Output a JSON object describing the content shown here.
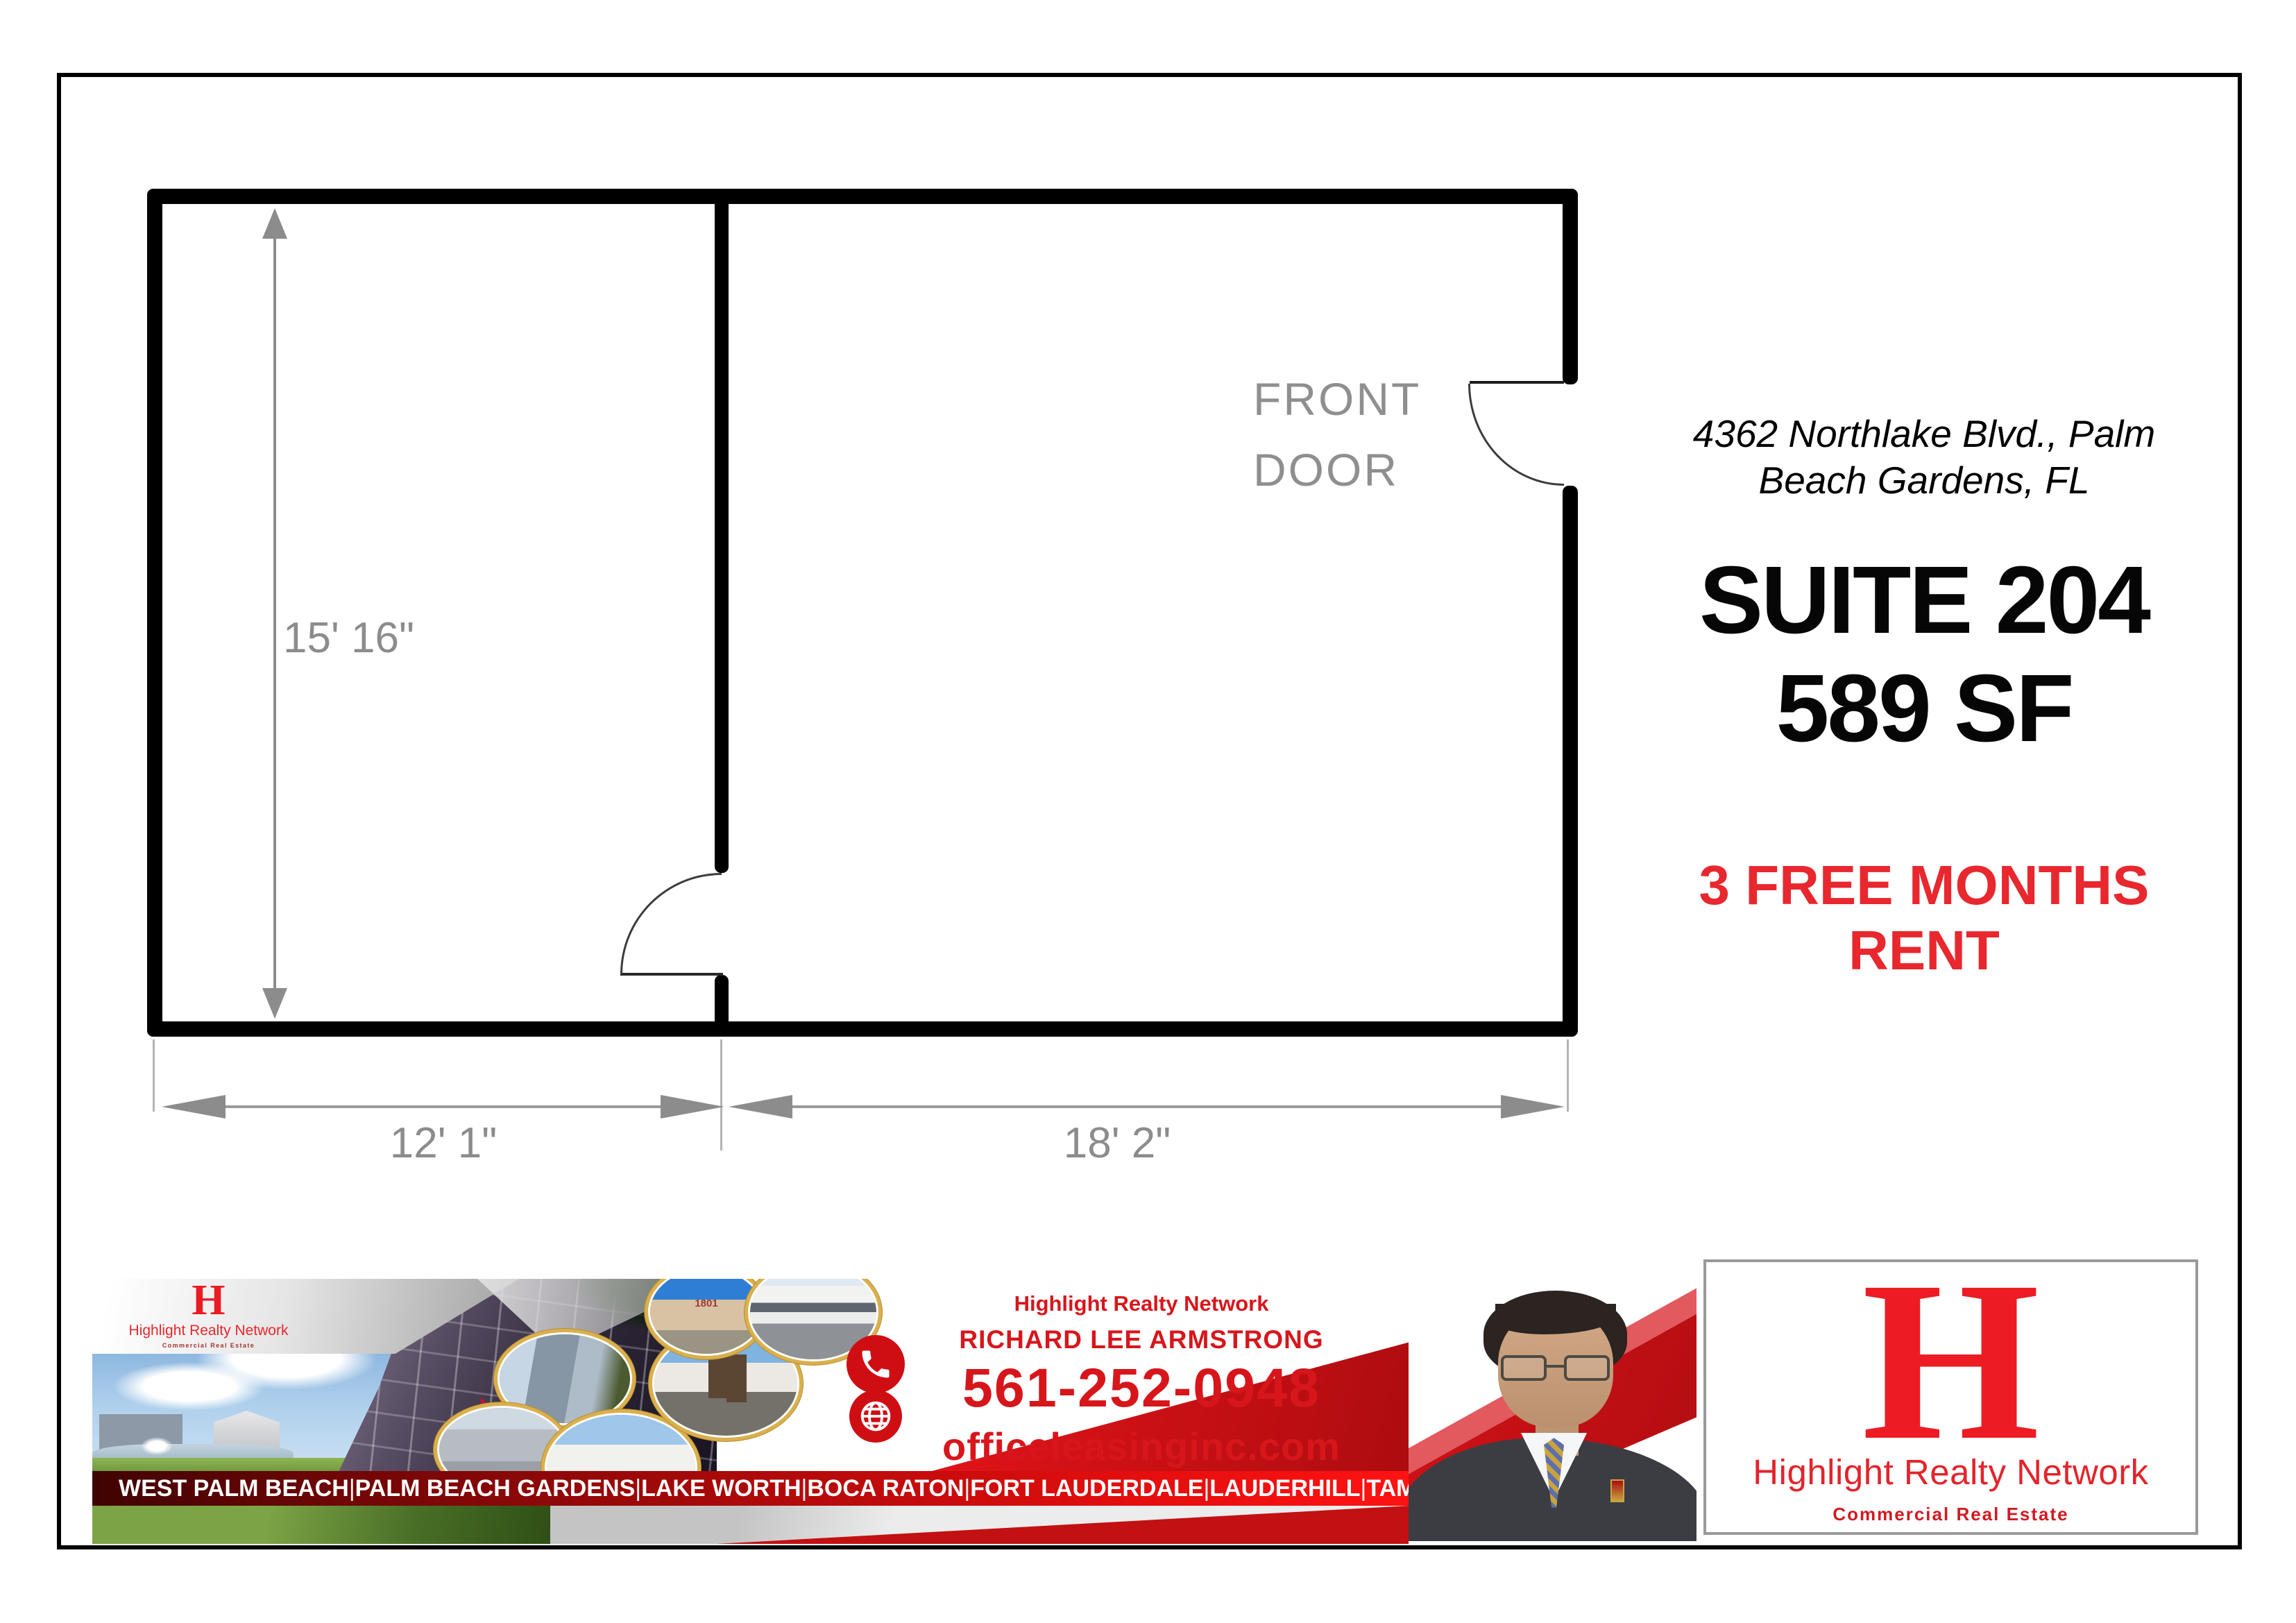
{
  "listing": {
    "address_line1": "4362 Northlake Blvd., Palm",
    "address_line2": "Beach Gardens, FL",
    "suite": "SUITE 204",
    "area": "589 SF",
    "promo_line1": "3 FREE MONTHS",
    "promo_line2": "RENT",
    "promo_color": "#e8272e"
  },
  "floorplan": {
    "front_door_line1": "FRONT",
    "front_door_line2": "DOOR",
    "dim_height": "15' 16\"",
    "dim_width_left": "12' 1\"",
    "dim_width_right": "18' 2\""
  },
  "banner": {
    "logo_monogram": "H",
    "logo_name": "Highlight Realty Network",
    "logo_tagline": "Commercial Real Estate",
    "network_title": "Highlight Realty Network",
    "agent_name": "RICHARD LEE ARMSTRONG",
    "phone": "561-252-0948",
    "website": "officeleasinginc.com",
    "oval_photo_label": "1801",
    "cities": [
      "WEST PALM BEACH",
      "PALM BEACH GARDENS",
      "LAKE WORTH",
      "BOCA RATON",
      "FORT LAUDERDALE",
      "LAUDERHILL",
      "TAMARAC"
    ],
    "city_separator": "|"
  },
  "logo_box": {
    "monogram": "H",
    "name": "Highlight Realty Network",
    "tagline": "Commercial Real Estate"
  },
  "colors": {
    "brand_red": "#d7161c",
    "strip_dark_red": "#3f0303",
    "strip_bright_red": "#ff1212",
    "dim_gray": "#8c8c8c",
    "wall_black": "#000000"
  }
}
